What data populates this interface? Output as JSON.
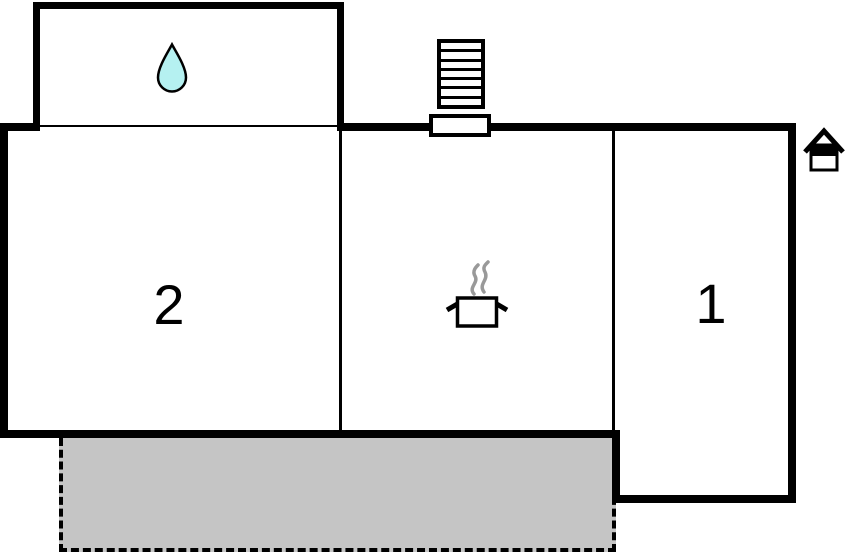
{
  "plan": {
    "title": "holiday-home-floor-plan",
    "room_labels": [
      {
        "id": "bedroom-2",
        "label": "2"
      },
      {
        "id": "bedroom-1",
        "label": "1"
      }
    ],
    "icons": {
      "water_drop": {
        "meaning": "bathroom",
        "fill": "#b5f1f1",
        "stroke": "#000000"
      },
      "cooking_pot": {
        "meaning": "kitchen",
        "steam_color": "#999999",
        "outline": "#000000"
      },
      "stairs": {
        "meaning": "exterior-stairs",
        "steps": 7
      },
      "entrance_house": {
        "meaning": "entrance-marker",
        "outline": "#000000"
      }
    },
    "colors": {
      "background": "#ffffff",
      "walls": "#000000",
      "terrace_fill": "#c5c5c5"
    }
  }
}
